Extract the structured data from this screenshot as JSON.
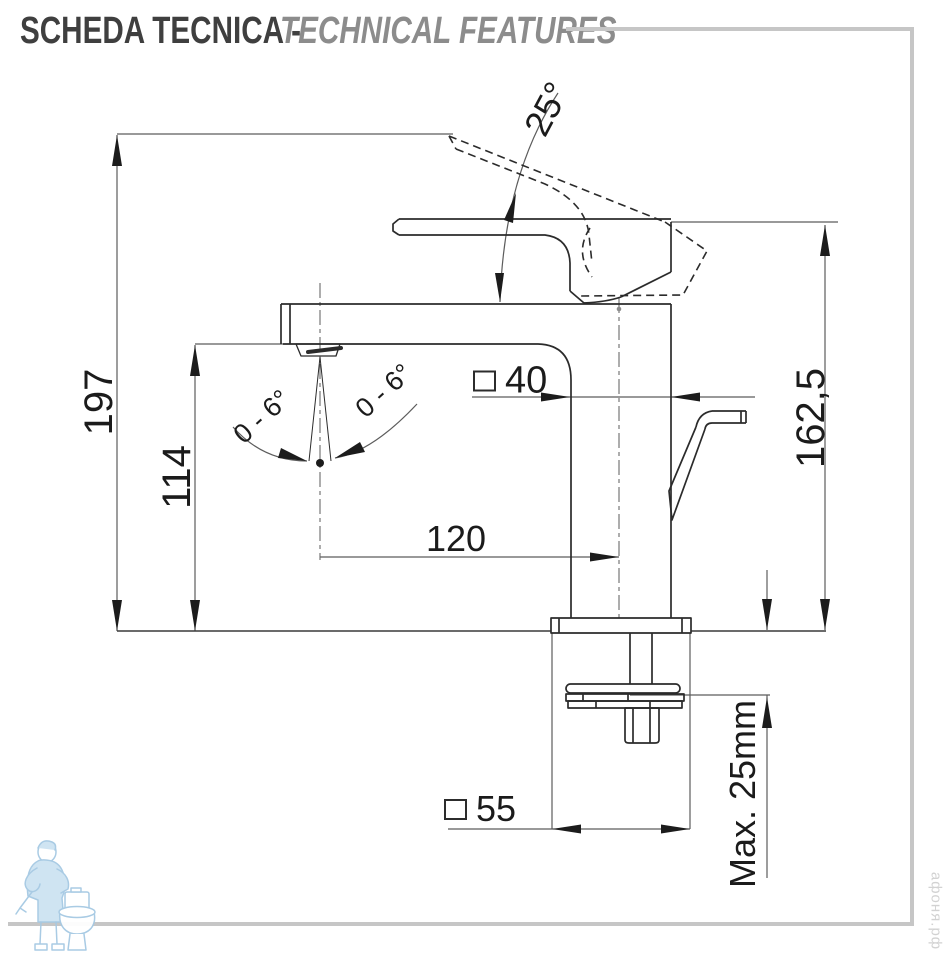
{
  "header": {
    "title_primary": "SCHEDA TECNICA -",
    "title_secondary": "TECHNICAL FEATURES"
  },
  "diagram": {
    "type": "technical-drawing",
    "dimensions": {
      "overall_height": "197",
      "spout_outlet_height": "114",
      "height_to_lever_top": "162,5",
      "spout_reach_from_axis": "120",
      "body_section_square": "40",
      "base_section_square": "55",
      "max_deck_thickness": "Max. 25mm",
      "lever_opening_angle": "25°",
      "aerator_swivel_left": "0 - 6°",
      "aerator_swivel_right": "0 - 6°"
    },
    "colors": {
      "part_line": "#2b2b2b",
      "dimension_line": "#5c5c5c",
      "frame_rule": "#c6c6c6",
      "watermark_blue": "#a5c9e3"
    }
  },
  "watermarks": {
    "site": "афоня.рф",
    "logo_icon": "plumber-with-toilet"
  }
}
